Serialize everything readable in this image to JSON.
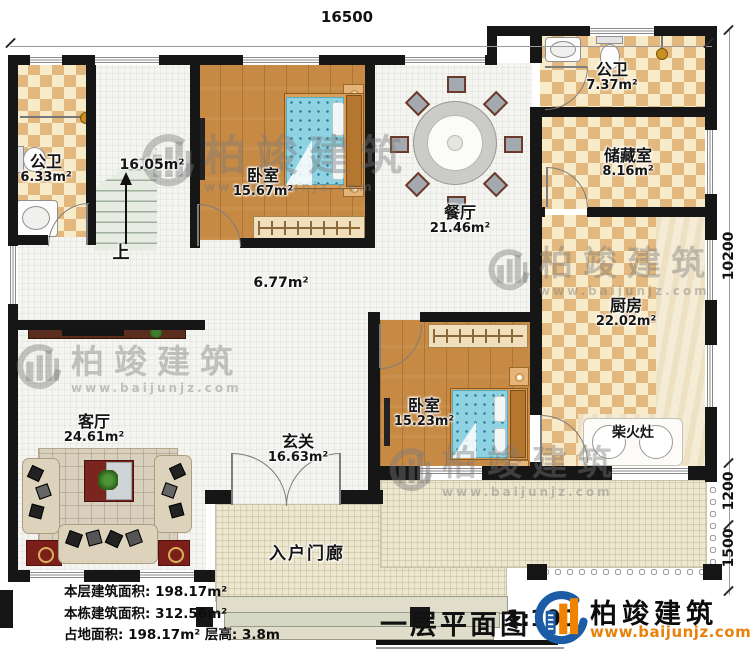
{
  "dimensions": {
    "top": "16500",
    "right_a": "10200",
    "right_b": "1200",
    "right_c": "1500"
  },
  "rooms": {
    "bath1": {
      "name": "公卫",
      "area": "6.33m²"
    },
    "bath2": {
      "name": "公卫",
      "area": "7.37m²"
    },
    "storage": {
      "name": "储藏室",
      "area": "8.16m²"
    },
    "bedroom1": {
      "name": "卧室",
      "area": "15.67m²"
    },
    "bedroom2": {
      "name": "卧室",
      "area": "15.23m²"
    },
    "dining": {
      "name": "餐厅",
      "area": "21.46m²"
    },
    "kitchen": {
      "name": "厨房",
      "area": "22.02m²"
    },
    "living": {
      "name": "客厅",
      "area": "24.61m²"
    },
    "foyer": {
      "name": "玄关",
      "area": "16.63m²"
    },
    "hallway": {
      "area": "6.77m²"
    },
    "stairs": {
      "area": "16.05m²",
      "up_label": "上"
    },
    "stove": {
      "name": "柴火灶"
    },
    "porch": {
      "name": "入户门廊"
    }
  },
  "stats": {
    "line1": "本层建筑面积: 198.17m²",
    "line2": "本栋建筑面积: 312.56m²",
    "line3": "占地面积: 198.17m²  层高: 3.8m"
  },
  "titleblock": {
    "title": "一层平面图",
    "scale": "1:100"
  },
  "brand": {
    "name": "柏竣建筑",
    "url": "www.baijunjz.com"
  },
  "watermark": {
    "name": "柏竣建筑",
    "url": "www.baijunjz.com"
  },
  "colors": {
    "accent_blue": "#1c5ba6",
    "accent_orange": "#f08300",
    "wall": "#161616"
  }
}
